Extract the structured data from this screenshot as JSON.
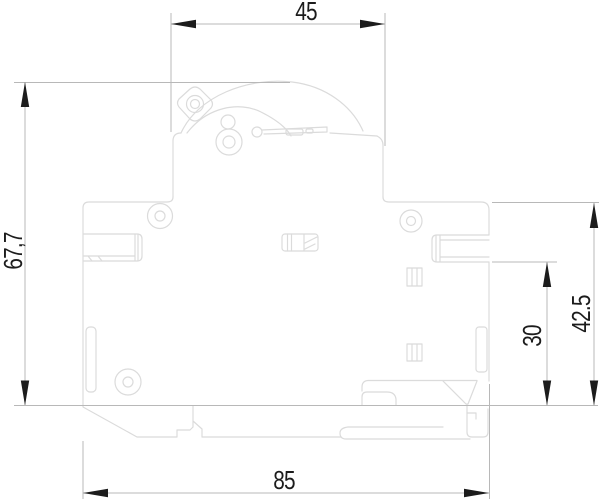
{
  "drawing": {
    "dimensions": {
      "top_width": "45",
      "left_height": "67,7",
      "right_inner_height": "30",
      "right_height": "42.5",
      "bottom_width": "85"
    },
    "colors": {
      "background": "#ffffff",
      "body_line": "#dbdbdb",
      "dim_line": "#b8b8b8",
      "ink": "#1c1c1c"
    }
  }
}
